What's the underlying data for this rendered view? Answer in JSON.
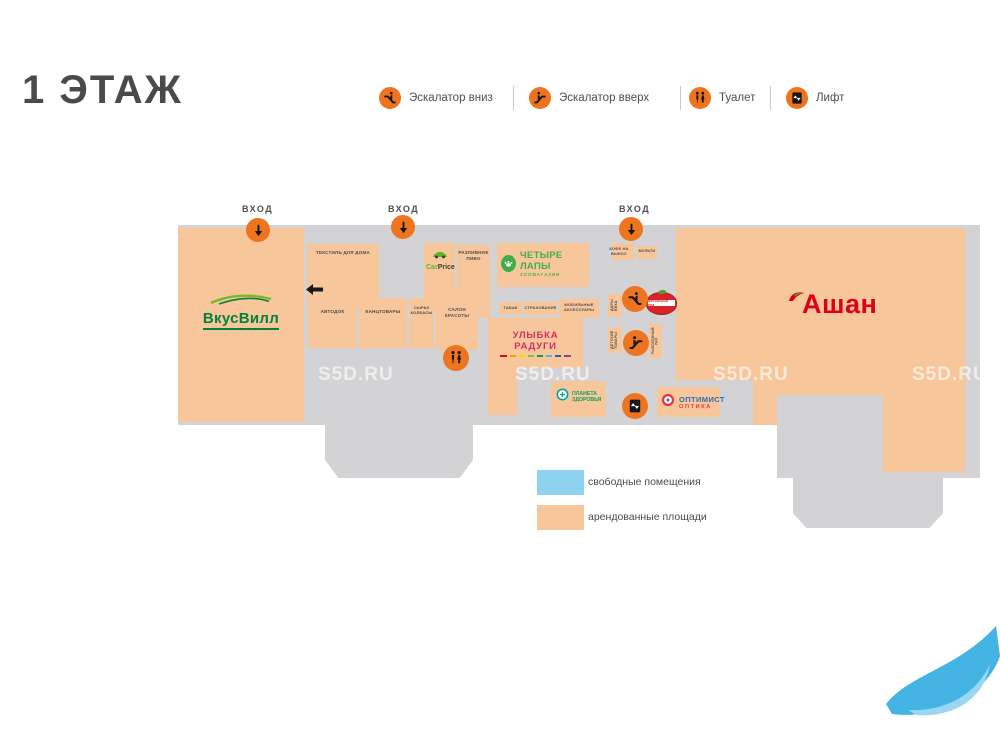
{
  "page": {
    "title": "1 ЭТАЖ",
    "watermark": "S5D.RU"
  },
  "map_legend_top": {
    "items": [
      {
        "icon": "escalator-down-icon",
        "label": "Эскалатор вниз"
      },
      {
        "icon": "escalator-up-icon",
        "label": "Эскалатор вверх"
      },
      {
        "icon": "toilet-icon",
        "label": "Туалет"
      },
      {
        "icon": "lift-icon",
        "label": "Лифт"
      }
    ]
  },
  "entrances": {
    "label": "ВХОД",
    "count": 3
  },
  "stores": {
    "vkusvill": "ВкусВилл",
    "tekstil": "ТЕКСТИЛЬ ДЛЯ ДОМА",
    "carprice": {
      "car": "Car",
      "price": "Price"
    },
    "razlivnoe": "РАЗЛИВНОЕ ПИВО",
    "chetyre_lapy": {
      "name": "ЧЕТЫРЕ ЛАПЫ",
      "sub": "ЗООМАГАЗИН"
    },
    "kofe": "КОФЕ НА ВЫНОС",
    "multi": "МУЛЬТИ",
    "avtodok": "АВТОДОК",
    "kanctovary": "КАНЦТОВАРЫ",
    "syry": "СЫРЫ/ КОЛБАСЫ",
    "salon": "САЛОН КРАСОТЫ",
    "tabak": "ТАБАК",
    "strahovanie": "СТРАХОВАНИЕ",
    "mobilnye": "МОБИЛЬНЫЕ АКСЕССУАРЫ",
    "ulybka": "УЛЫБКА РАДУГИ",
    "dary": "ДАРЫ ВЕКА",
    "detskie": "ДЕТСКИЕ ТОВАРЫ",
    "rybolov": "РЫБОЛОВНЫЙ РАЙ",
    "myasnitsky": "МЯСНИЦКИЙ РЯД",
    "planeta": {
      "line1": "ПЛАНЕТА",
      "line2": "ЗДОРОВЬЯ"
    },
    "optimist": {
      "name": "ОПТИМИСТ",
      "sub": "ОПТИКА"
    },
    "auchan": "Ашан"
  },
  "area_legend": {
    "free": {
      "label": "свободные помещения",
      "color": "#8ed1f1"
    },
    "rented": {
      "label": "арендованные площади",
      "color": "#f8c69b"
    }
  },
  "colors": {
    "corridor_gray": "#d3d3d5",
    "rented_orange": "#f8c69b",
    "icon_orange": "#ee7420",
    "auchan_red": "#dd0018",
    "vkusvill_green": "#00843d",
    "lapy_green": "#3fae49",
    "ulybka_pink": "#d42e66",
    "planeta_green": "#11a05e",
    "optimist_blue": "#2a6db5",
    "optimist_red": "#e63946"
  },
  "ulybka_dash_colors": [
    "#e30613",
    "#f59c00",
    "#ffd500",
    "#8fc33c",
    "#00a553",
    "#4db4e7",
    "#2b5fa8",
    "#7d4998"
  ]
}
